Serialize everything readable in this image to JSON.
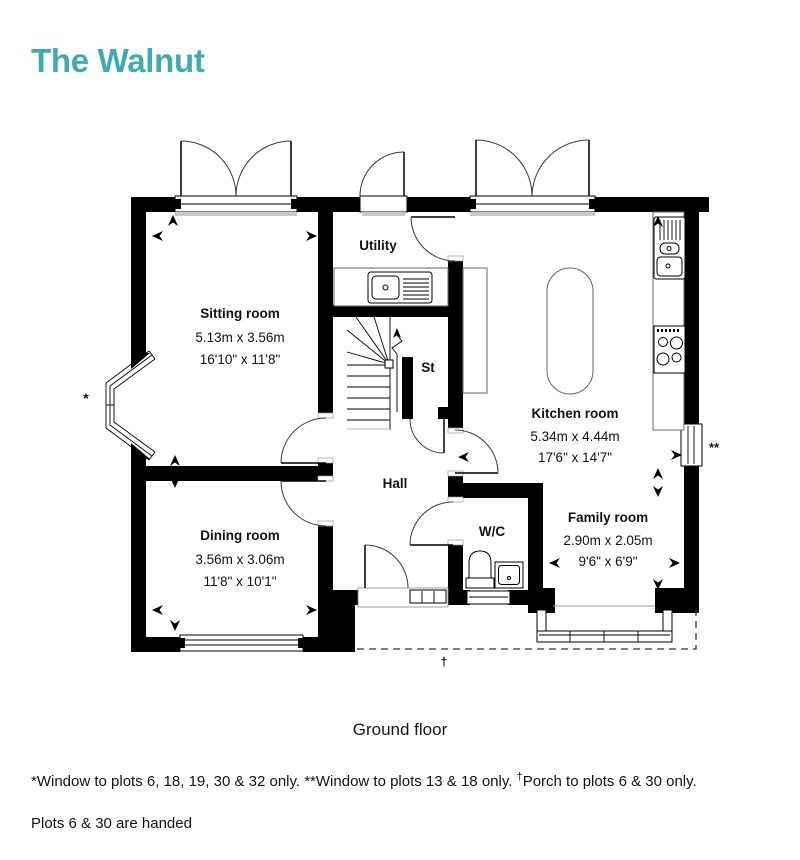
{
  "header": {
    "title": "The Walnut",
    "accent_color": "#3cacb1"
  },
  "plan": {
    "rooms": {
      "sitting": {
        "name": "Sitting room",
        "metric": "5.13m x 3.56m",
        "imperial": "16'10\" x 11'8\""
      },
      "dining": {
        "name": "Dining room",
        "metric": "3.56m x 3.06m",
        "imperial": "11'8\" x 10'1\""
      },
      "kitchen": {
        "name": "Kitchen room",
        "metric": "5.34m x 4.44m",
        "imperial": "17'6\" x 14'7\""
      },
      "family": {
        "name": "Family room",
        "metric": "2.90m x 2.05m",
        "imperial": "9'6\" x 6'9\""
      },
      "utility": {
        "name": "Utility"
      },
      "hall": {
        "name": "Hall"
      },
      "store": {
        "name": "St"
      },
      "wc": {
        "name": "W/C"
      }
    },
    "markers": {
      "bay_window_note": "*",
      "kitchen_window_note": "**",
      "porch_note": "†"
    }
  },
  "caption": {
    "floor_label": "Ground floor"
  },
  "footnotes": {
    "line1_part1": "*Window to plots 6, 18, 19, 30 & 32 only. **Window to plots 13 & 18 only. ",
    "line1_dagger": "†",
    "line1_part2": "Porch to plots 6 & 30 only.",
    "line2": "Plots 6 & 30 are handed"
  }
}
